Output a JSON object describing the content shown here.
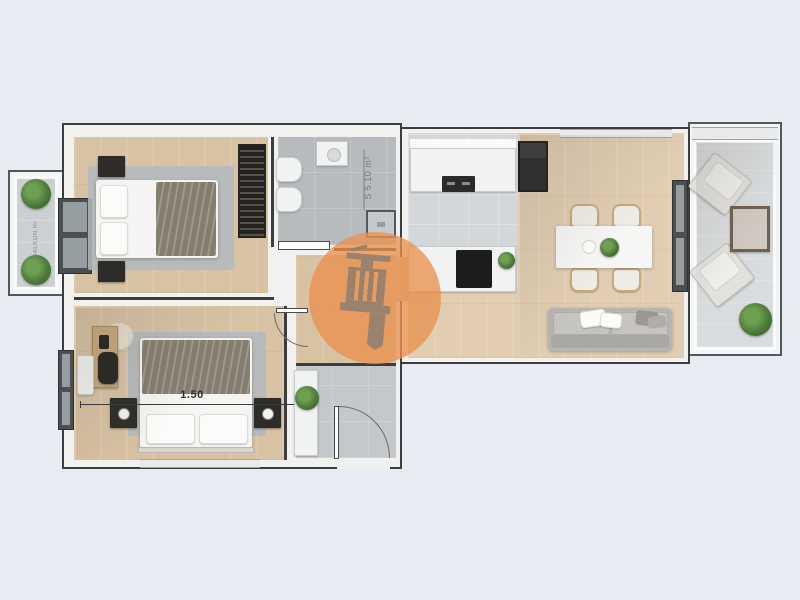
{
  "scene": {
    "type": "apartment-floorplan-top-view",
    "background_color": "#e9ebf2",
    "labels": {
      "bed_width_dimension": "1.50",
      "bathroom_area": "S 5.10 m²",
      "left_balcony": "BALKON m²"
    },
    "watermark": {
      "shape": "circle",
      "color": "#e9914e",
      "icon": "tower-building-icon",
      "icon_color": "#8f7e6e"
    },
    "palette": {
      "wood_floor": "#d8c2a4",
      "bathroom_tile": "#b7bbbe",
      "kitchen_tile": "#d4d7d9",
      "entry_tile": "#c5c8cb",
      "wall_line": "#3d3d3d",
      "wall_fill": "#f1f1f0",
      "rug_gray": "#b2bac0",
      "blanket_taupe": "#8e8779",
      "dark_furniture": "#2d2c29",
      "sofa_gray": "#b7b5b1",
      "chair_wood": "#c9a87c",
      "plant_green": "#4f7d3c"
    }
  }
}
